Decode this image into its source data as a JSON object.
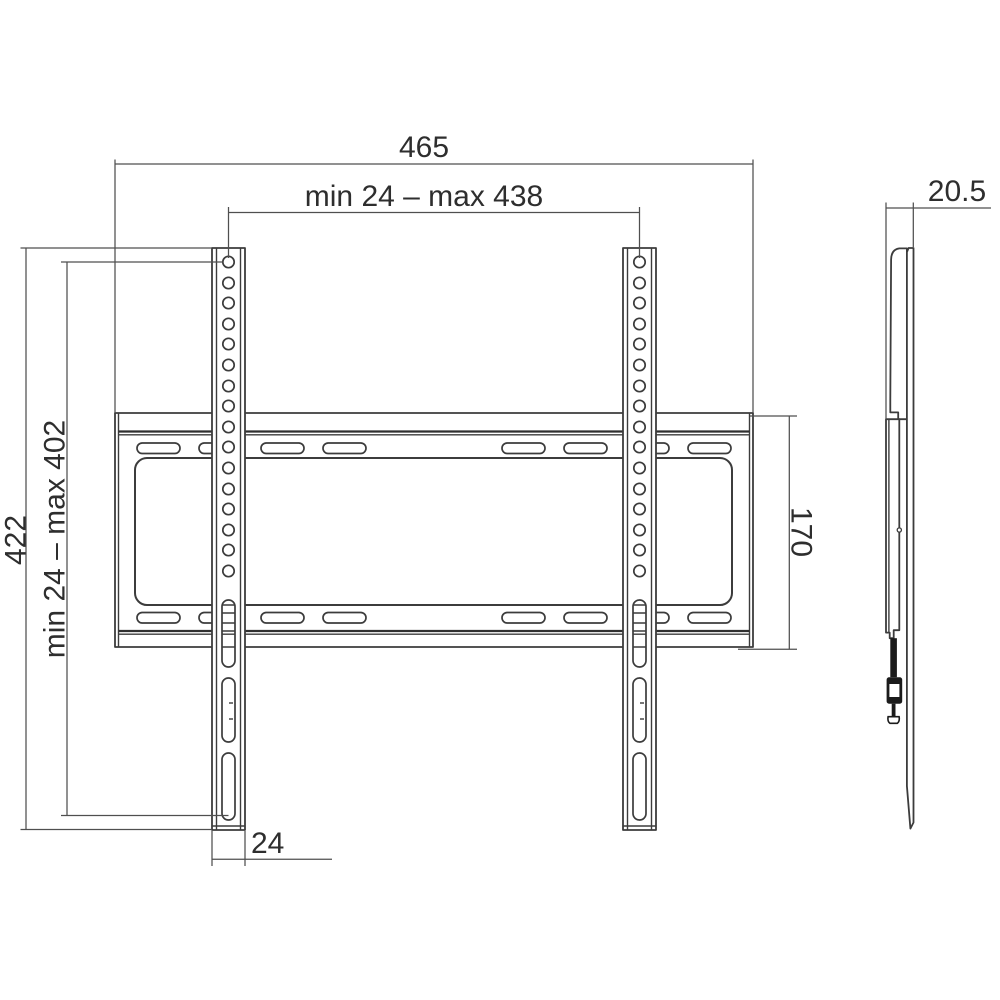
{
  "drawing": {
    "subject": "wall-mount-bracket-dimension-drawing",
    "unit": "mm",
    "colors": {
      "background": "#ffffff",
      "outline": "#3c3c3c",
      "dimension_lines": "#4f4f4f",
      "text": "#2e2e2e",
      "screw_fill": "#1b1b1b"
    },
    "front_view": {
      "rail_hole_count": 16,
      "rail_slot_count": 3,
      "plate_slot_rows": 2,
      "plate_slots_per_row": 8
    },
    "dimensions": {
      "overall_width": "465",
      "mount_width_range": "min 24 – max 438",
      "overall_height": "422",
      "mount_height_range": "min 24 – max 402",
      "plate_height": "170",
      "rail_width": "24",
      "profile_depth": "20.5"
    }
  }
}
